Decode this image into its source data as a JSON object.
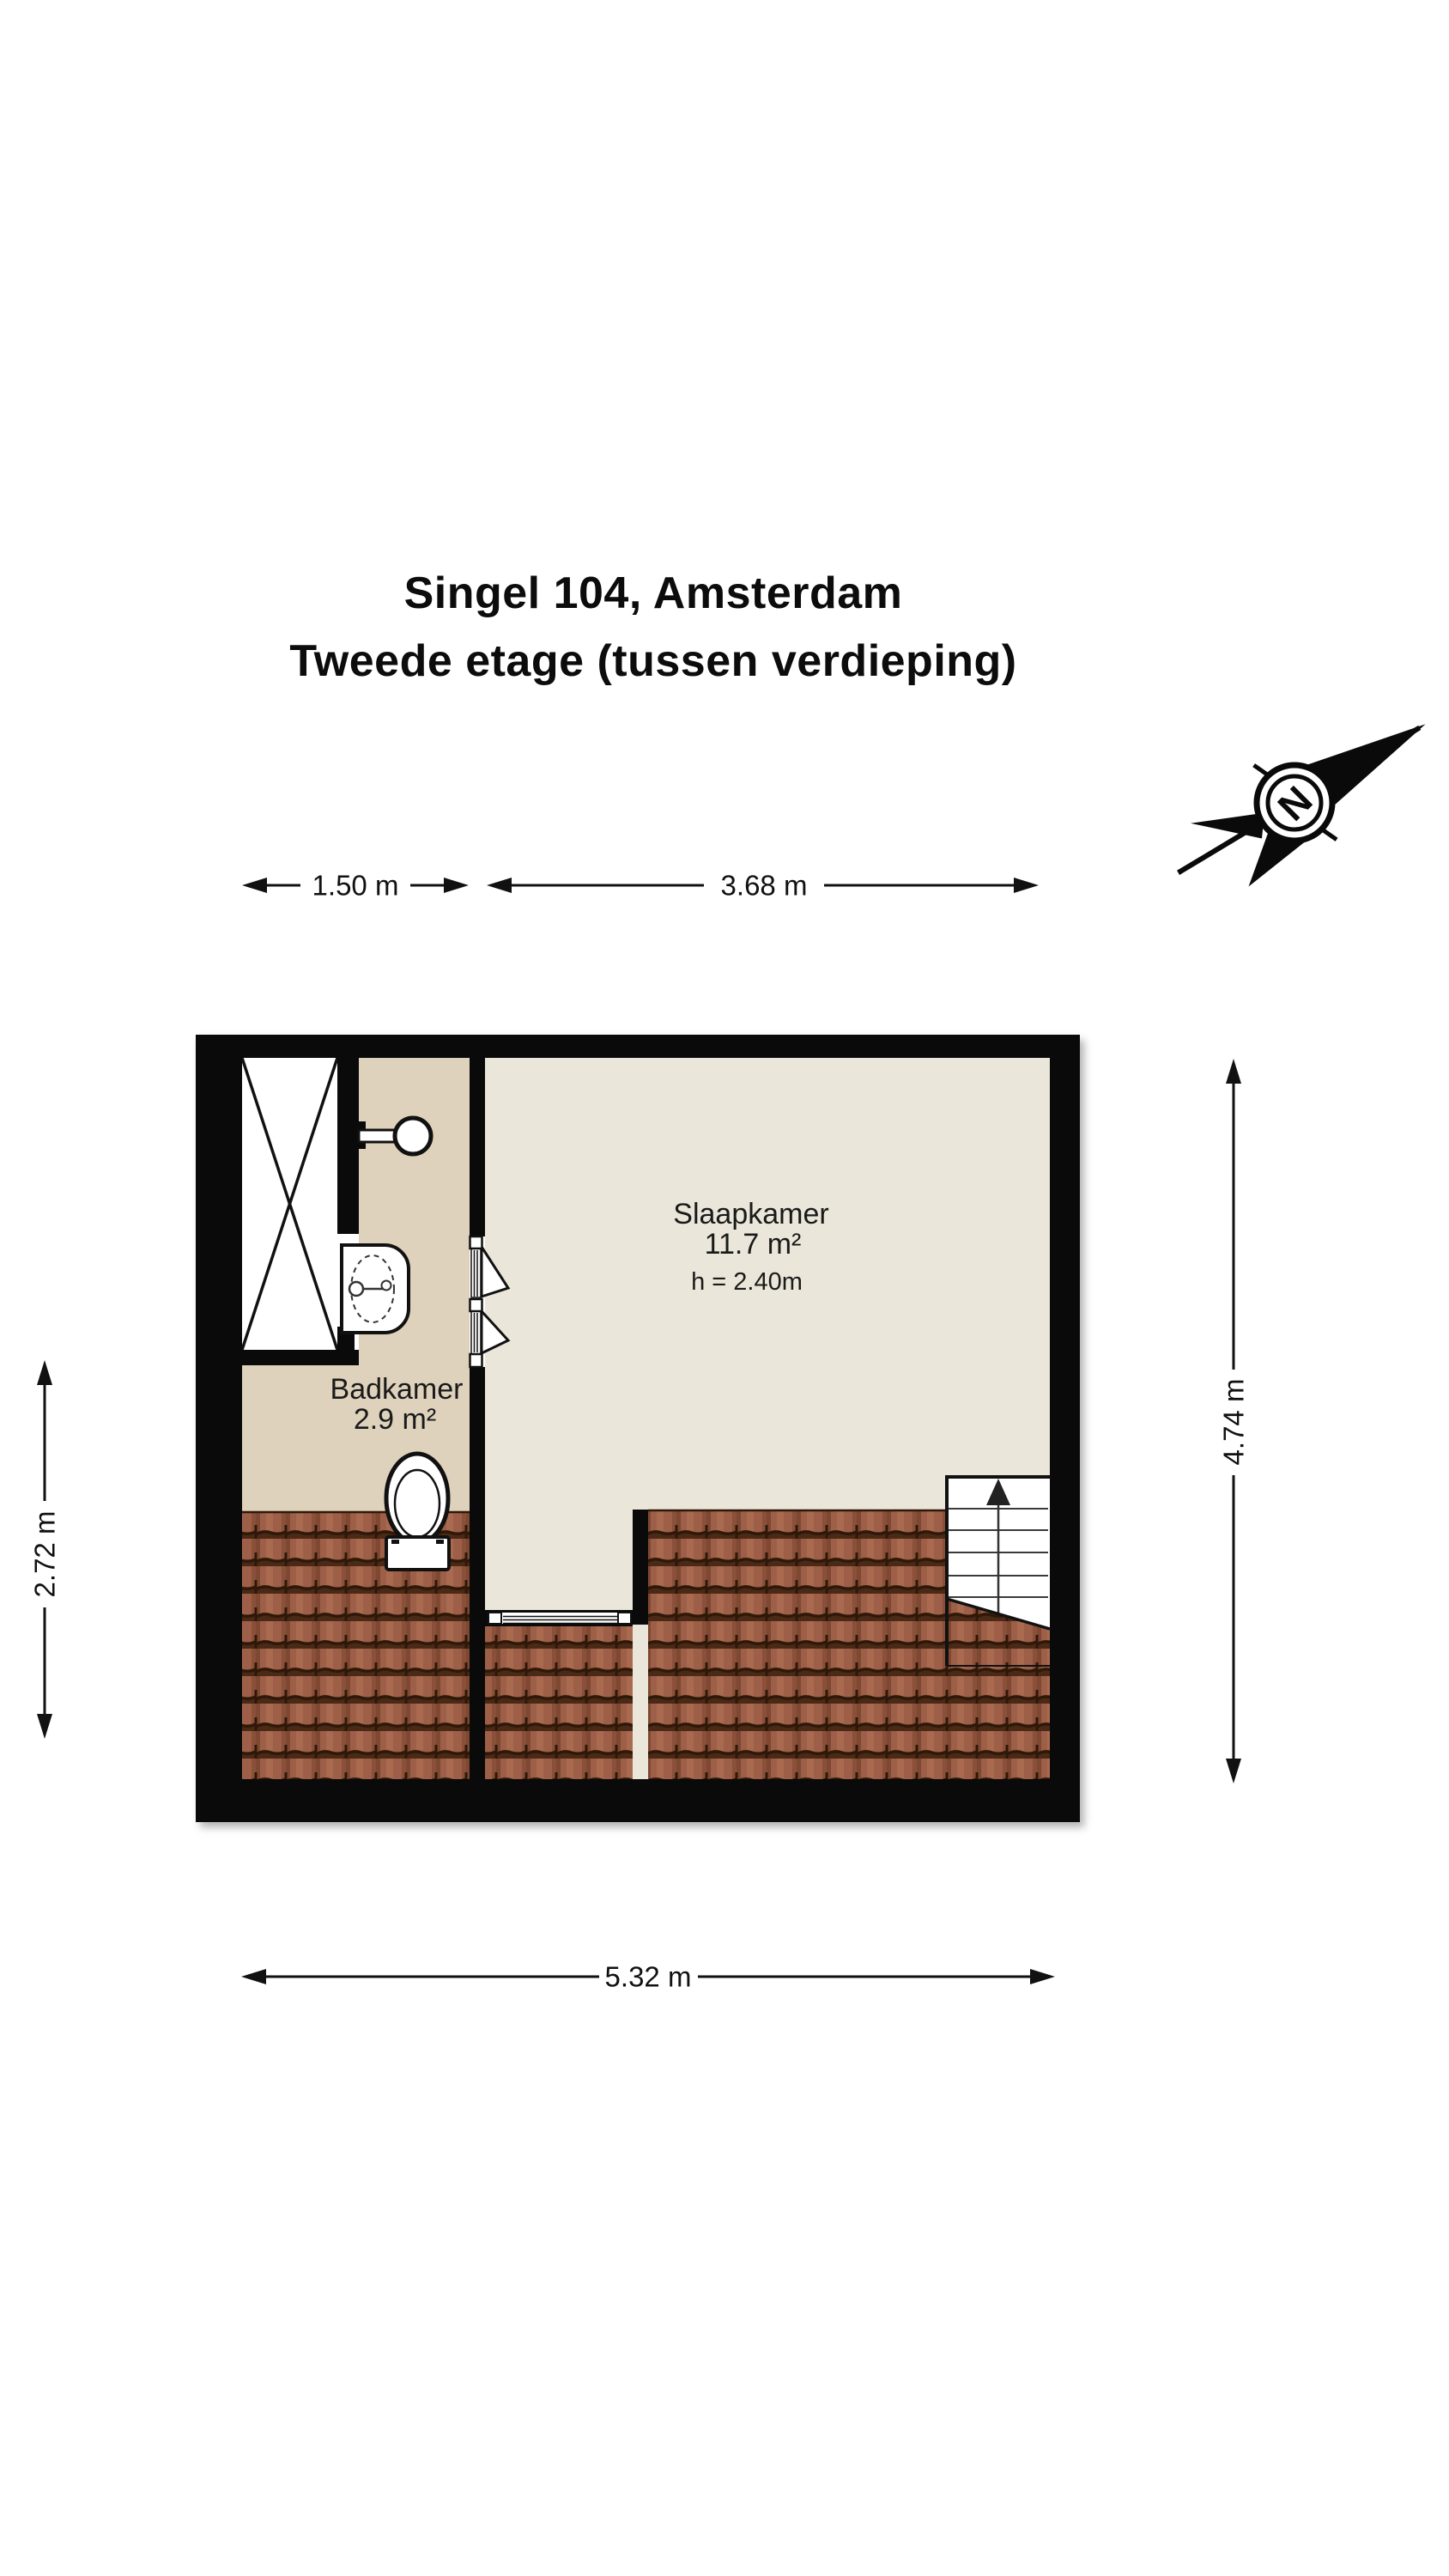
{
  "title": {
    "line1": "Singel 104, Amsterdam",
    "line2": "Tweede etage (tussen verdieping)"
  },
  "compass": {
    "label": "N"
  },
  "dimensions": {
    "top_left": "1.50 m",
    "top_right": "3.68 m",
    "left": "2.72 m",
    "right": "4.74 m",
    "bottom": "5.32 m"
  },
  "rooms": {
    "slaapkamer": {
      "name": "Slaapkamer",
      "area": "11.7 m²",
      "ceiling_height": "h = 2.40m"
    },
    "badkamer": {
      "name": "Badkamer",
      "area": "2.9 m²"
    }
  },
  "colors": {
    "wall": "#0a0a0a",
    "bedroom_floor": "#ebe6da",
    "bathroom_floor": "#ded2bc",
    "roof_tile": "#9d5f48",
    "roof_tile_dark": "#2f1808",
    "fixture_white": "#ffffff",
    "text": "#111111"
  }
}
